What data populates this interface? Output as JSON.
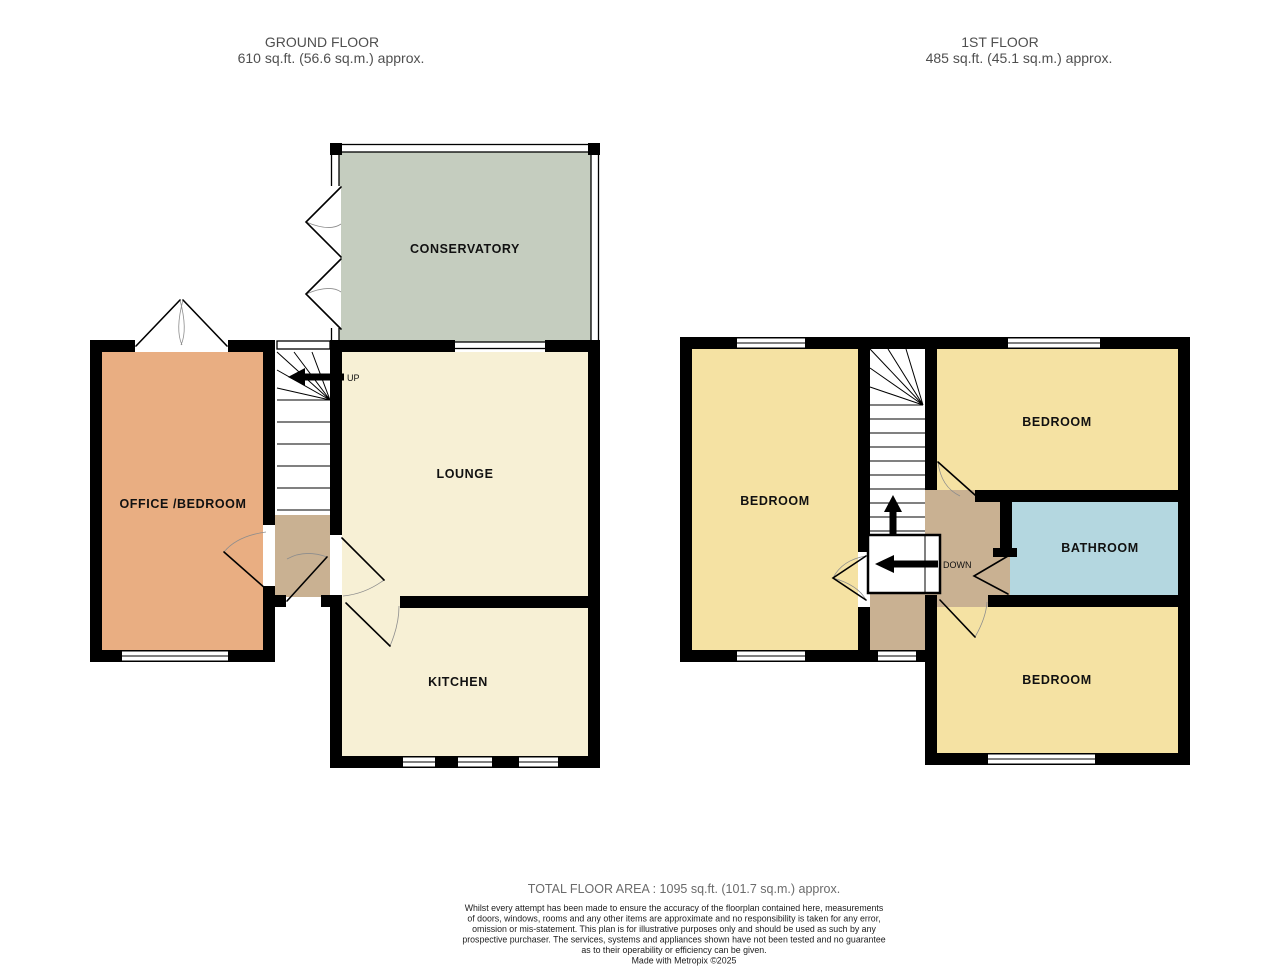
{
  "header": {
    "ground_floor": {
      "title": "GROUND FLOOR",
      "area": "610 sq.ft. (56.6 sq.m.) approx."
    },
    "first_floor": {
      "title": "1ST FLOOR",
      "area": "485 sq.ft. (45.1 sq.m.) approx."
    }
  },
  "ground_floor": {
    "rooms": {
      "conservatory": "CONSERVATORY",
      "lounge": "LOUNGE",
      "office_bedroom": "OFFICE /BEDROOM",
      "kitchen": "KITCHEN"
    },
    "stairs_label": "UP"
  },
  "first_floor": {
    "rooms": {
      "bedroom_left": "BEDROOM",
      "bedroom_top": "BEDROOM",
      "bathroom": "BATHROOM",
      "bedroom_bottom": "BEDROOM"
    },
    "stairs_label": "DOWN"
  },
  "footer": {
    "total_area": "TOTAL FLOOR AREA : 1095 sq.ft. (101.7 sq.m.) approx.",
    "disclaimer_lines": [
      "Whilst every attempt has been made to ensure the accuracy of the floorplan contained here, measurements",
      "of doors, windows, rooms and any other items are approximate and no responsibility is taken for any error,",
      "omission or mis-statement. This plan is for illustrative purposes only and should be used as such by any",
      "prospective purchaser. The services, systems and appliances shown have not been tested and no guarantee",
      "as to their operability or efficiency can be given."
    ],
    "credit": "Made with Metropix ©2025"
  },
  "colors": {
    "wall": "#000000",
    "conservatory": "#c5cdbf",
    "lounge_kitchen": "#f7f0d5",
    "office": "#e9ae82",
    "bedroom": "#f5e2a3",
    "bathroom": "#b4d7e0",
    "hall": "#c9b192"
  }
}
